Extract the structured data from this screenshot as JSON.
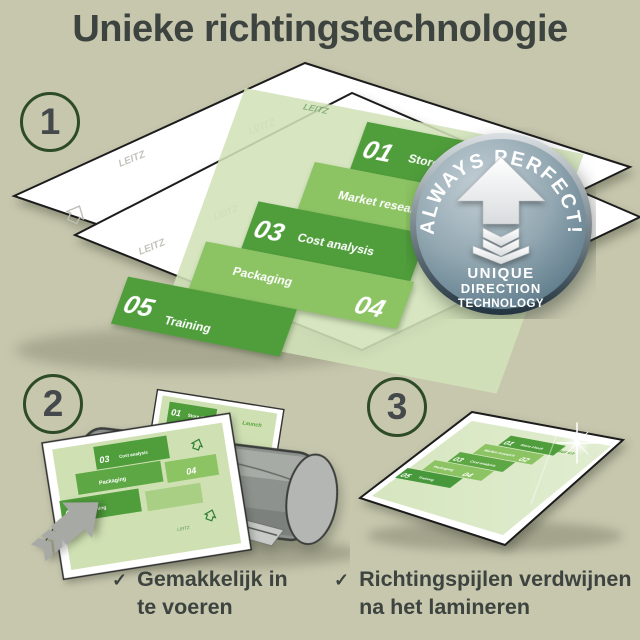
{
  "page": {
    "title": "Unieke richtingstechnologie"
  },
  "steps": [
    {
      "number": "1"
    },
    {
      "number": "2"
    },
    {
      "number": "3"
    }
  ],
  "infographic": {
    "items": [
      {
        "num": "01",
        "label": "Store check"
      },
      {
        "num": "02",
        "label": "Market research"
      },
      {
        "num": "03",
        "label": "Cost analysis"
      },
      {
        "num": "04",
        "label": "Packaging"
      },
      {
        "num": "05",
        "label": "Training"
      }
    ],
    "launch": "Launch",
    "watermark": "LEITZ"
  },
  "badge": {
    "arc": "ALWAYS PERFECT!",
    "line1": "UNIQUE",
    "line2": "DIRECTION",
    "line3": "TECHNOLOGY"
  },
  "bullets": [
    {
      "check": "✓",
      "line1": "Gemakkelijk in",
      "line2": "te voeren"
    },
    {
      "check": "✓",
      "line1": "Richtingspijlen verdwijnen",
      "line2": "na het lamineren"
    }
  ],
  "colors": {
    "background": "#c7c7ae",
    "text": "#3d4440",
    "circle_ring": "#2d4b28",
    "green_dark": "#4f9e3b",
    "green_light": "#8cc363",
    "green_page": "#d2e3b8",
    "badge_blue": "#5d7888",
    "machine_gray": "#8d928e",
    "arrow_gray": "#a7a9a5"
  }
}
